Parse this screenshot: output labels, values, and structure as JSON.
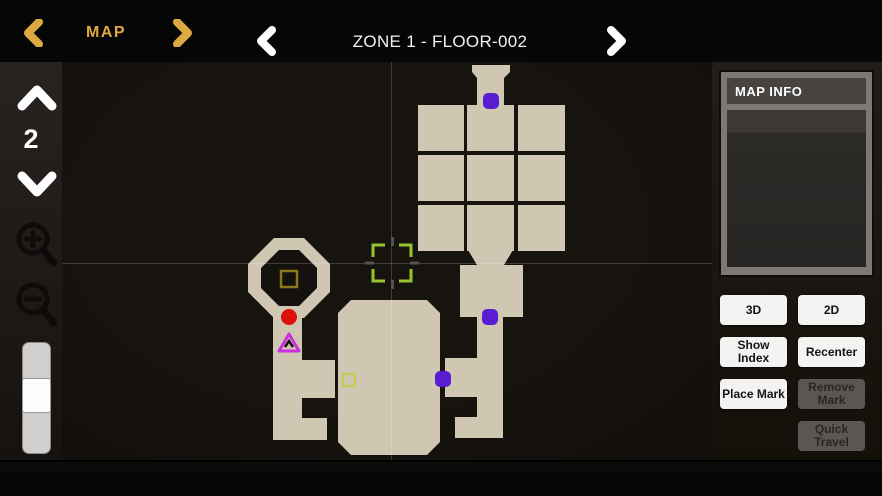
{
  "topbar": {
    "map_label": "MAP",
    "floor_title": "ZONE 1 - FLOOR-002"
  },
  "toolbar": {
    "floor_number": "2"
  },
  "panel": {
    "info_title": "MAP INFO",
    "buttons": [
      {
        "label": "3D",
        "enabled": true
      },
      {
        "label": "2D",
        "enabled": true
      },
      {
        "label": "Show Index",
        "enabled": true
      },
      {
        "label": "Recenter",
        "enabled": true
      },
      {
        "label": "Place Mark",
        "enabled": true
      },
      {
        "label": "Remove Mark",
        "enabled": false
      },
      {
        "label": "Quick Travel",
        "enabled": false
      }
    ]
  },
  "map": {
    "colors": {
      "room_fill": "#d0c7b2",
      "map_bg": "#14110e",
      "purple_marker": "#5a1cd1",
      "red_marker": "#dd100c",
      "player_magenta": "#d02ce0",
      "cursor_green": "#94c52e",
      "yellow_box": "#c9c92a",
      "olive_box": "#867a16",
      "crosshair": "rgba(255,255,255,0.18)",
      "tick": "#55534d"
    },
    "crosshair": {
      "x": 329.5,
      "y": 201.5
    },
    "rooms": [
      {
        "name": "entry-funnel",
        "poly": [
          [
            410,
            3
          ],
          [
            448,
            3
          ],
          [
            448,
            10
          ],
          [
            442,
            16
          ],
          [
            442,
            43
          ],
          [
            415,
            43
          ],
          [
            415,
            16
          ],
          [
            410,
            10
          ]
        ]
      },
      {
        "name": "grid-cell-1-1",
        "rect": [
          356,
          43,
          46,
          46
        ]
      },
      {
        "name": "grid-cell-1-2",
        "rect": [
          405,
          43,
          47,
          46
        ]
      },
      {
        "name": "grid-cell-1-3",
        "rect": [
          456,
          43,
          47,
          46
        ]
      },
      {
        "name": "grid-cell-2-1",
        "rect": [
          356,
          93,
          46,
          46
        ]
      },
      {
        "name": "grid-cell-2-2",
        "rect": [
          405,
          93,
          47,
          46
        ]
      },
      {
        "name": "grid-cell-2-3",
        "rect": [
          456,
          93,
          47,
          46
        ]
      },
      {
        "name": "grid-cell-3-1",
        "rect": [
          356,
          143,
          46,
          46
        ]
      },
      {
        "name": "grid-cell-3-2",
        "rect": [
          405,
          143,
          47,
          46
        ]
      },
      {
        "name": "grid-cell-3-3",
        "rect": [
          456,
          143,
          47,
          46
        ]
      },
      {
        "name": "grid-neck",
        "poly": [
          [
            406,
            188
          ],
          [
            451,
            188
          ],
          [
            442,
            203
          ],
          [
            415,
            203
          ]
        ]
      },
      {
        "name": "room-below-grid",
        "rect": [
          398,
          203,
          63,
          52
        ]
      },
      {
        "name": "right-comb",
        "poly": [
          [
            415,
            255
          ],
          [
            441,
            255
          ],
          [
            441,
            376
          ],
          [
            393,
            376
          ],
          [
            393,
            355
          ],
          [
            415,
            355
          ],
          [
            415,
            335
          ],
          [
            383,
            335
          ],
          [
            383,
            296
          ],
          [
            415,
            296
          ]
        ]
      },
      {
        "name": "big-room",
        "poly": [
          [
            289,
            238
          ],
          [
            365,
            238
          ],
          [
            378,
            251
          ],
          [
            378,
            380
          ],
          [
            365,
            393
          ],
          [
            289,
            393
          ],
          [
            276,
            380
          ],
          [
            276,
            251
          ]
        ]
      },
      {
        "name": "octagon-ring",
        "poly": [
          [
            212,
            176
          ],
          [
            242,
            176
          ],
          [
            268,
            202
          ],
          [
            268,
            230
          ],
          [
            242,
            256
          ],
          [
            212,
            256
          ],
          [
            186,
            230
          ],
          [
            186,
            202
          ]
        ]
      },
      {
        "name": "octagon-hole",
        "poly": [
          [
            217,
            188
          ],
          [
            237,
            188
          ],
          [
            255,
            206
          ],
          [
            255,
            226
          ],
          [
            237,
            244
          ],
          [
            217,
            244
          ],
          [
            199,
            226
          ],
          [
            199,
            206
          ]
        ],
        "fill": "hole"
      },
      {
        "name": "left-comb",
        "poly": [
          [
            211,
            252
          ],
          [
            240,
            252
          ],
          [
            240,
            298
          ],
          [
            273,
            298
          ],
          [
            273,
            336
          ],
          [
            240,
            336
          ],
          [
            240,
            356
          ],
          [
            265,
            356
          ],
          [
            265,
            378
          ],
          [
            211,
            378
          ]
        ]
      }
    ],
    "markers": [
      {
        "type": "purple-dot",
        "name": "door-marker-top",
        "x": 429,
        "y": 39
      },
      {
        "type": "purple-dot",
        "name": "door-marker-mid",
        "x": 428,
        "y": 255
      },
      {
        "type": "purple-dot",
        "name": "door-marker-low",
        "x": 381,
        "y": 317
      },
      {
        "type": "red-dot",
        "name": "red-marker",
        "x": 227,
        "y": 255
      },
      {
        "type": "player-triangle",
        "name": "player-marker",
        "x": 227,
        "y": 281
      },
      {
        "type": "olive-square",
        "name": "olive-box-marker",
        "x": 227,
        "y": 217
      },
      {
        "type": "yellow-square",
        "name": "yellow-box-marker",
        "x": 287,
        "y": 318
      },
      {
        "type": "cursor",
        "name": "selection-cursor",
        "x": 330,
        "y": 201,
        "w": 38,
        "h": 36
      }
    ]
  }
}
